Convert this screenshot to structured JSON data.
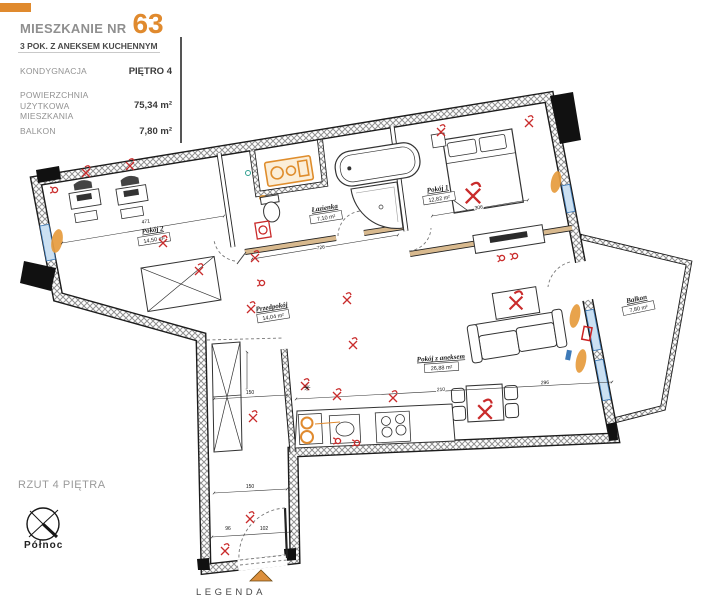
{
  "header": {
    "title_label": "MIESZKANIE NR",
    "apartment_number": "63",
    "subtitle": "3 POK. Z ANEKSEM KUCHENNYM",
    "specs": [
      {
        "label": "KONDYGNACJA",
        "value": "PIĘTRO 4"
      },
      {
        "label": "POWIERZCHNIA UŻYTKOWA MIESZKANIA",
        "value": "75,34 m²"
      },
      {
        "label": "BALKON",
        "value": "7,80 m²"
      }
    ]
  },
  "plan": {
    "watermark": "MAKLER",
    "rooms": [
      {
        "name": "Pokój 2",
        "area": "14,50 m²"
      },
      {
        "name": "Łazienka",
        "area": "7,10 m²"
      },
      {
        "name": "Pokój 1",
        "area": "12,82 m²"
      },
      {
        "name": "Przedpokój",
        "area": "14,04 m²"
      },
      {
        "name": "Pokój z aneksem",
        "area": "26,88 m²"
      },
      {
        "name": "Balkon",
        "area": "7,80 m²"
      }
    ],
    "dimensions": [
      "471",
      "726",
      "306",
      "210",
      "150",
      "150",
      "102",
      "96",
      "296"
    ],
    "asterisk_symbol": "✳"
  },
  "footer": {
    "plan_label": "RZUT 4 PIĘTRA",
    "compass_label": "Północ",
    "legend_label": "LEGENDA"
  },
  "colors": {
    "accent_orange": "#E08A2E",
    "symbol_red": "#C92B2B",
    "window_blue": "#3D7AB8",
    "wall_beige": "#D8B98E"
  }
}
